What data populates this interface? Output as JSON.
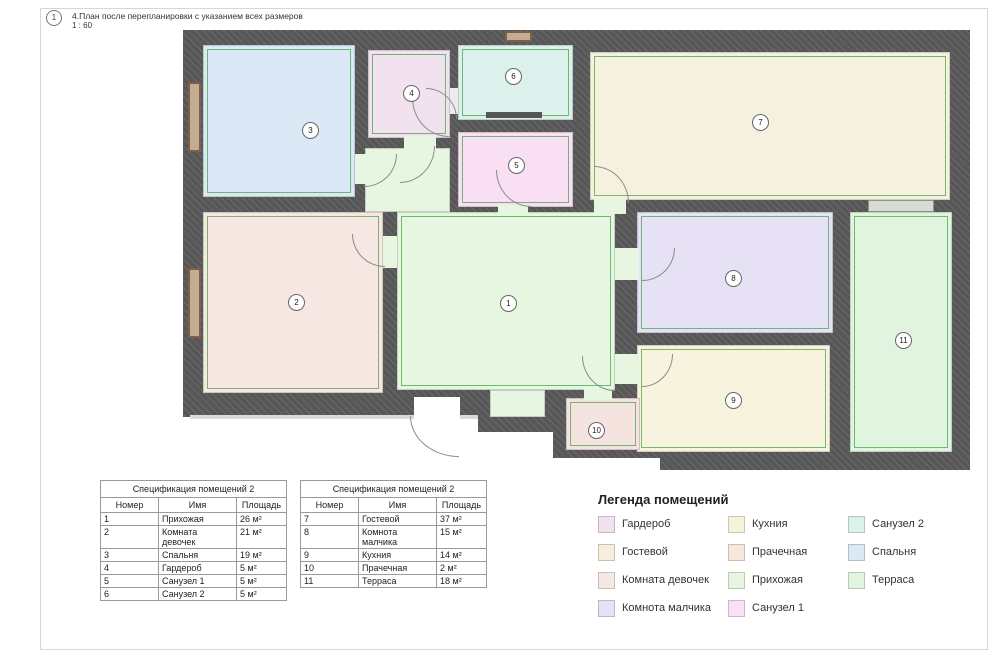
{
  "header": {
    "sheet_marker": "1",
    "title": "4.План после перепланировки с указанием всех размеров",
    "scale": "1 : 60"
  },
  "plan": {
    "dimension_color": "#3aa13a",
    "wall_color": "#595959",
    "window_color": "#8a6b55",
    "rooms": [
      {
        "number": "1",
        "color": "#e6f6e0"
      },
      {
        "number": "2",
        "color": "#f7e7e3"
      },
      {
        "number": "3",
        "color": "#dbe9f6"
      },
      {
        "number": "4",
        "color": "#f2e2f0"
      },
      {
        "number": "5",
        "color": "#f8dff3"
      },
      {
        "number": "6",
        "color": "#ddf1ec"
      },
      {
        "number": "7",
        "color": "#f6f1de"
      },
      {
        "number": "8",
        "color": "#e6e1f5"
      },
      {
        "number": "9",
        "color": "#f7f3df"
      },
      {
        "number": "10",
        "color": "#f5e3df"
      },
      {
        "number": "11",
        "color": "#e1f4df"
      }
    ]
  },
  "tables": [
    {
      "title": "Спецификация помещений 2",
      "columns": [
        "Номер",
        "Имя",
        "Площадь"
      ],
      "rows": [
        [
          "1",
          "Прихожая",
          "26 м²"
        ],
        [
          "2",
          "Комната девочек",
          "21 м²"
        ],
        [
          "3",
          "Спальня",
          "19 м²"
        ],
        [
          "4",
          "Гардероб",
          "5 м²"
        ],
        [
          "5",
          "Санузел 1",
          "5 м²"
        ],
        [
          "6",
          "Санузел 2",
          "5 м²"
        ]
      ]
    },
    {
      "title": "Спецификация помещений 2",
      "columns": [
        "Номер",
        "Имя",
        "Площадь"
      ],
      "rows": [
        [
          "7",
          "Гостевой",
          "37 м²"
        ],
        [
          "8",
          "Комнота малчика",
          "15 м²"
        ],
        [
          "9",
          "Кухния",
          "14 м²"
        ],
        [
          "10",
          "Прачечная",
          "2 м²"
        ],
        [
          "11",
          "Терраса",
          "18 м²"
        ]
      ]
    }
  ],
  "legend": {
    "title": "Легенда помещений",
    "items": [
      {
        "label": "Гардероб",
        "color": "#f2e2f0"
      },
      {
        "label": "Гостевой",
        "color": "#f6eddc"
      },
      {
        "label": "Комната девочек",
        "color": "#f7e7e3"
      },
      {
        "label": "Комнота малчика",
        "color": "#e6e1f5"
      },
      {
        "label": "Кухния",
        "color": "#f5f3da"
      },
      {
        "label": "Прачечная",
        "color": "#f6e9dc"
      },
      {
        "label": "Прихожая",
        "color": "#e6f6e0"
      },
      {
        "label": "Санузел 1",
        "color": "#fbdff4"
      },
      {
        "label": "Санузел 2",
        "color": "#ddf1ec"
      },
      {
        "label": "Спальня",
        "color": "#dbe9f6"
      },
      {
        "label": "Терраса",
        "color": "#e1f4df"
      }
    ]
  }
}
